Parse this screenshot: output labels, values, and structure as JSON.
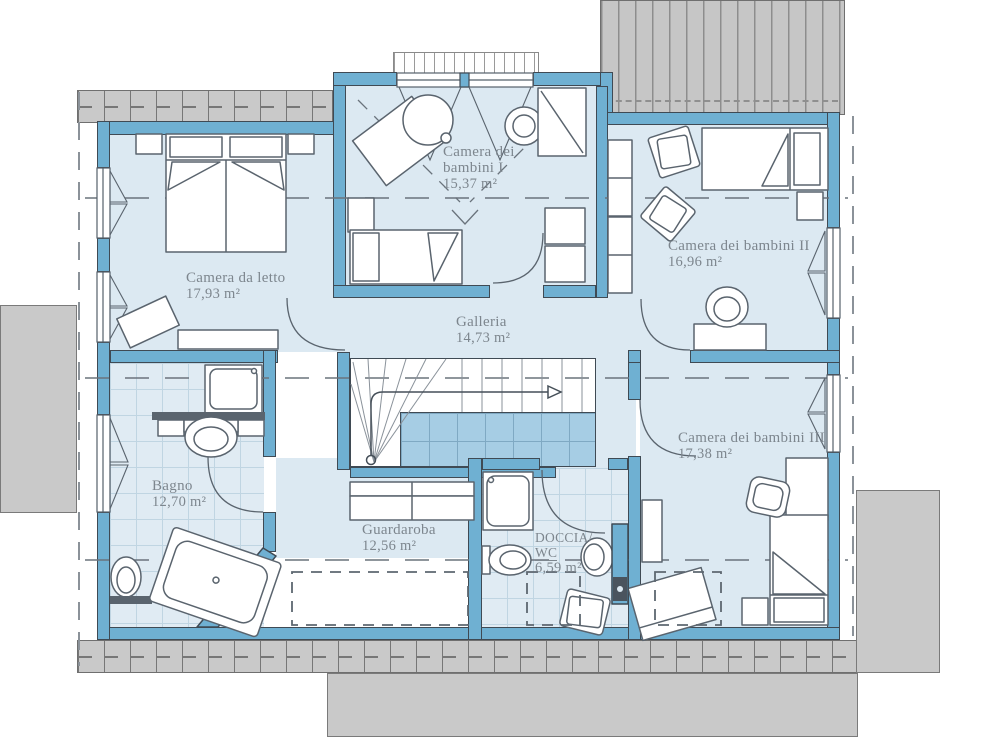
{
  "plan_type": "floor-plan",
  "rooms": {
    "camera_da_letto": {
      "name": "Camera da letto",
      "area": "17,93 m²"
    },
    "camera_bambini_1": {
      "name_line1": "Camera dei",
      "name_line2": "bambini I",
      "area": "15,37 m²"
    },
    "camera_bambini_2": {
      "name": "Camera dei bambini II",
      "area": "16,96 m²"
    },
    "galleria": {
      "name": "Galleria",
      "area": "14,73 m²"
    },
    "camera_bambini_3": {
      "name": "Camera dei bambini III",
      "area": "17,38 m²"
    },
    "bagno": {
      "name": "Bagno",
      "area": "12,70 m²"
    },
    "guardaroba": {
      "name": "Guardaroba",
      "area": "12,56 m²"
    },
    "doccia_wc": {
      "name_line1": "DOCCIA/",
      "name_line2": "WC",
      "area": "6,59 m²"
    }
  },
  "colors": {
    "wall": "#6fb0d2",
    "floor": "#dce9f2",
    "tile_floor": "#e0ebf3",
    "stair_void": "#a6cde4",
    "roof_gray": "#c9c9c9",
    "outline": "#3f4a54",
    "furniture_stroke": "#5a646e",
    "label_text": "#7d868e"
  }
}
